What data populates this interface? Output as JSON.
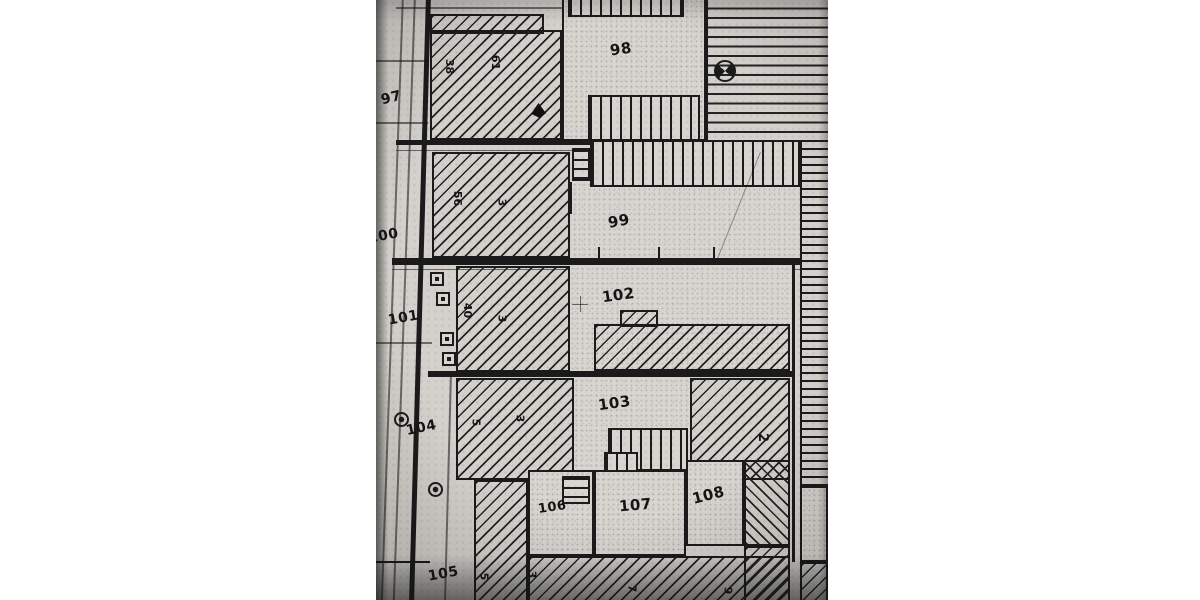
{
  "colors": {
    "canvas": "#ffffff",
    "paper": "#d4d1cc",
    "ink": "#1b1b1b"
  },
  "labels": {
    "p97": "97",
    "p98": "98",
    "p99": "99",
    "p100": "100",
    "p101": "101",
    "p102": "102",
    "p103": "103",
    "p104": "104",
    "p105": "105",
    "p106": "106",
    "p107": "107",
    "p108": "108",
    "a2": "2",
    "n38": "38",
    "n61": "61",
    "n56": "56",
    "n3a": "3",
    "n40": "40",
    "n3b": "3",
    "n5a": "5",
    "n3c": "3",
    "n5b": "5",
    "n3d": "3",
    "n7": "7",
    "n9": "9"
  },
  "symbols": [
    {
      "name": "quartered-circle-survey-marker"
    },
    {
      "name": "black-triangle-marker"
    },
    {
      "name": "cross-grid-marker"
    },
    {
      "name": "square-boundary-marker",
      "count": 4
    },
    {
      "name": "round-tree-marker",
      "count": 2
    }
  ]
}
